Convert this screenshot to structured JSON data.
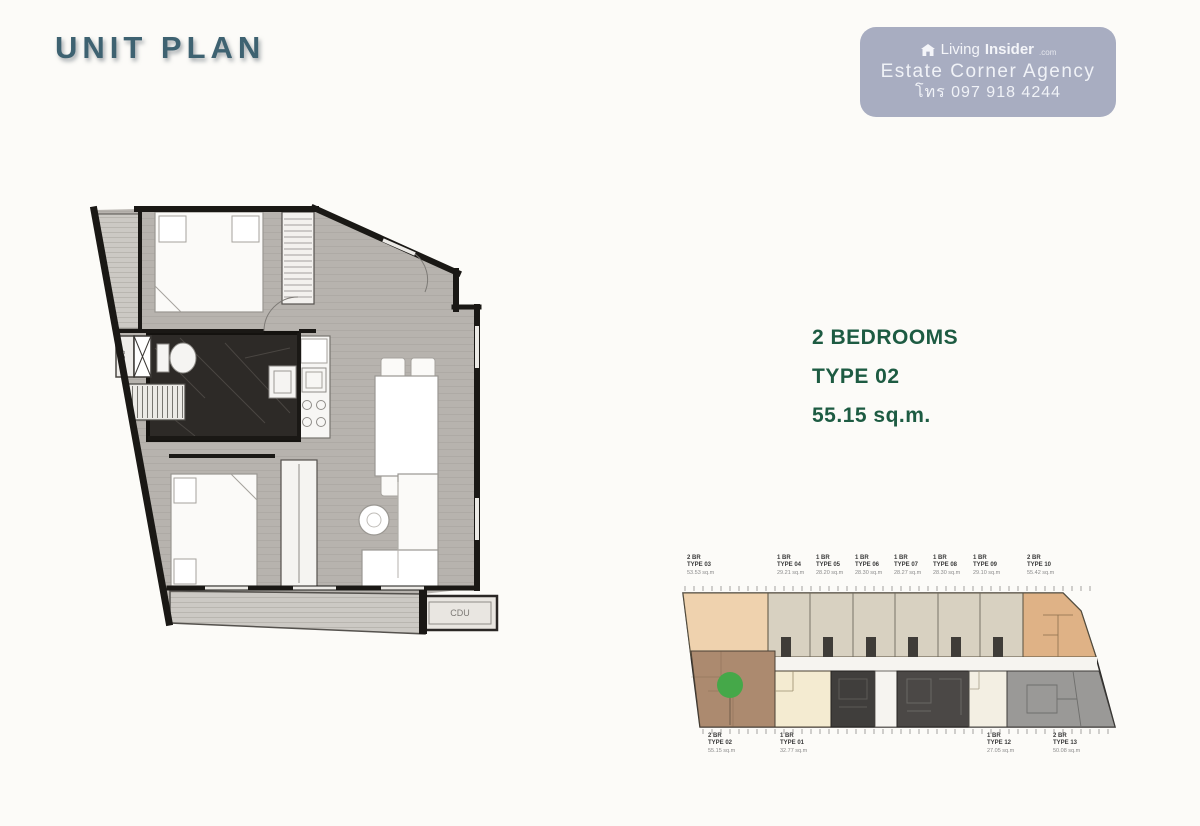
{
  "page": {
    "title": "UNIT PLAN"
  },
  "watermark": {
    "brand_light": "Living",
    "brand_bold": "Insider",
    "brand_suffix": ".com",
    "agency": "Estate Corner Agency",
    "phone": "โทร 097 918 4244",
    "bg_color": "#a8adc1"
  },
  "unit_info": {
    "bedrooms": "2 BEDROOMS",
    "type": "TYPE 02",
    "area": "55.15 sq.m.",
    "text_color": "#1d5b42"
  },
  "main_plan": {
    "fcu_label": "FCU",
    "cdu_label": "CDU"
  },
  "floor_plate": {
    "highlight_color": "#45a849",
    "top_units": [
      {
        "br": "2 BR",
        "type": "TYPE 03",
        "area": "53.53 sq.m"
      },
      {
        "br": "1 BR",
        "type": "TYPE 04",
        "area": "29.21 sq.m"
      },
      {
        "br": "1 BR",
        "type": "TYPE 05",
        "area": "28.20 sq.m"
      },
      {
        "br": "1 BR",
        "type": "TYPE 06",
        "area": "28.30 sq.m"
      },
      {
        "br": "1 BR",
        "type": "TYPE 07",
        "area": "28.27 sq.m"
      },
      {
        "br": "1 BR",
        "type": "TYPE 08",
        "area": "28.30 sq.m"
      },
      {
        "br": "1 BR",
        "type": "TYPE 09",
        "area": "29.10 sq.m"
      },
      {
        "br": "2 BR",
        "type": "TYPE 10",
        "area": "55.42 sq.m"
      }
    ],
    "bottom_units": [
      {
        "br": "2 BR",
        "type": "TYPE 02",
        "area": "55.15 sq.m"
      },
      {
        "br": "1 BR",
        "type": "TYPE 01",
        "area": "32.77 sq.m"
      },
      {
        "br": "1 BR",
        "type": "TYPE 12",
        "area": "27.05 sq.m"
      },
      {
        "br": "2 BR",
        "type": "TYPE 13",
        "area": "50.08 sq.m"
      }
    ]
  }
}
